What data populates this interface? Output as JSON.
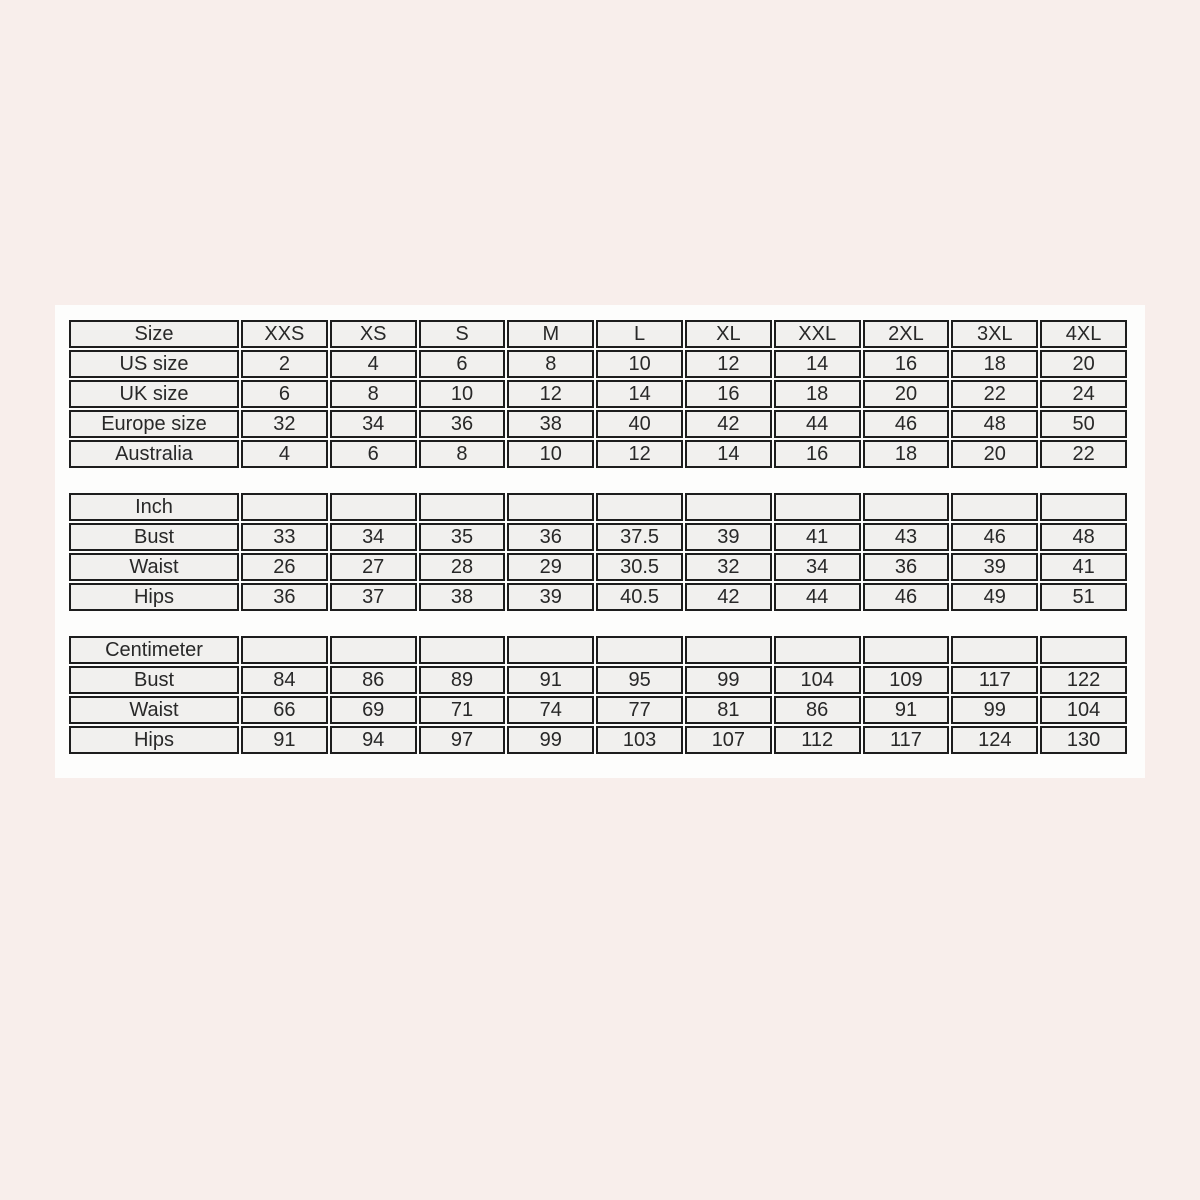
{
  "page": {
    "background_color": "#f8eeeb",
    "panel_background_color": "#fdfdfc",
    "cell_background_color": "#f1f0ee",
    "border_color": "#1d1d1d",
    "text_color": "#282828"
  },
  "tables": [
    {
      "name": "size-conversion-table",
      "header_label": "Size",
      "columns": [
        "XXS",
        "XS",
        "S",
        "M",
        "L",
        "XL",
        "XXL",
        "2XL",
        "3XL",
        "4XL"
      ],
      "rows": [
        {
          "label": "US size",
          "values": [
            "2",
            "4",
            "6",
            "8",
            "10",
            "12",
            "14",
            "16",
            "18",
            "20"
          ]
        },
        {
          "label": "UK size",
          "values": [
            "6",
            "8",
            "10",
            "12",
            "14",
            "16",
            "18",
            "20",
            "22",
            "24"
          ]
        },
        {
          "label": "Europe size",
          "values": [
            "32",
            "34",
            "36",
            "38",
            "40",
            "42",
            "44",
            "46",
            "48",
            "50"
          ]
        },
        {
          "label": "Australia",
          "values": [
            "4",
            "6",
            "8",
            "10",
            "12",
            "14",
            "16",
            "18",
            "20",
            "22"
          ]
        }
      ]
    },
    {
      "name": "inch-measurements-table",
      "header_label": "Inch",
      "columns": [
        "",
        "",
        "",
        "",
        "",
        "",
        "",
        "",
        "",
        ""
      ],
      "rows": [
        {
          "label": "Bust",
          "values": [
            "33",
            "34",
            "35",
            "36",
            "37.5",
            "39",
            "41",
            "43",
            "46",
            "48"
          ]
        },
        {
          "label": "Waist",
          "values": [
            "26",
            "27",
            "28",
            "29",
            "30.5",
            "32",
            "34",
            "36",
            "39",
            "41"
          ]
        },
        {
          "label": "Hips",
          "values": [
            "36",
            "37",
            "38",
            "39",
            "40.5",
            "42",
            "44",
            "46",
            "49",
            "51"
          ]
        }
      ]
    },
    {
      "name": "centimeter-measurements-table",
      "header_label": "Centimeter",
      "columns": [
        "",
        "",
        "",
        "",
        "",
        "",
        "",
        "",
        "",
        ""
      ],
      "rows": [
        {
          "label": "Bust",
          "values": [
            "84",
            "86",
            "89",
            "91",
            "95",
            "99",
            "104",
            "109",
            "117",
            "122"
          ]
        },
        {
          "label": "Waist",
          "values": [
            "66",
            "69",
            "71",
            "74",
            "77",
            "81",
            "86",
            "91",
            "99",
            "104"
          ]
        },
        {
          "label": "Hips",
          "values": [
            "91",
            "94",
            "97",
            "99",
            "103",
            "107",
            "112",
            "117",
            "124",
            "130"
          ]
        }
      ]
    }
  ]
}
